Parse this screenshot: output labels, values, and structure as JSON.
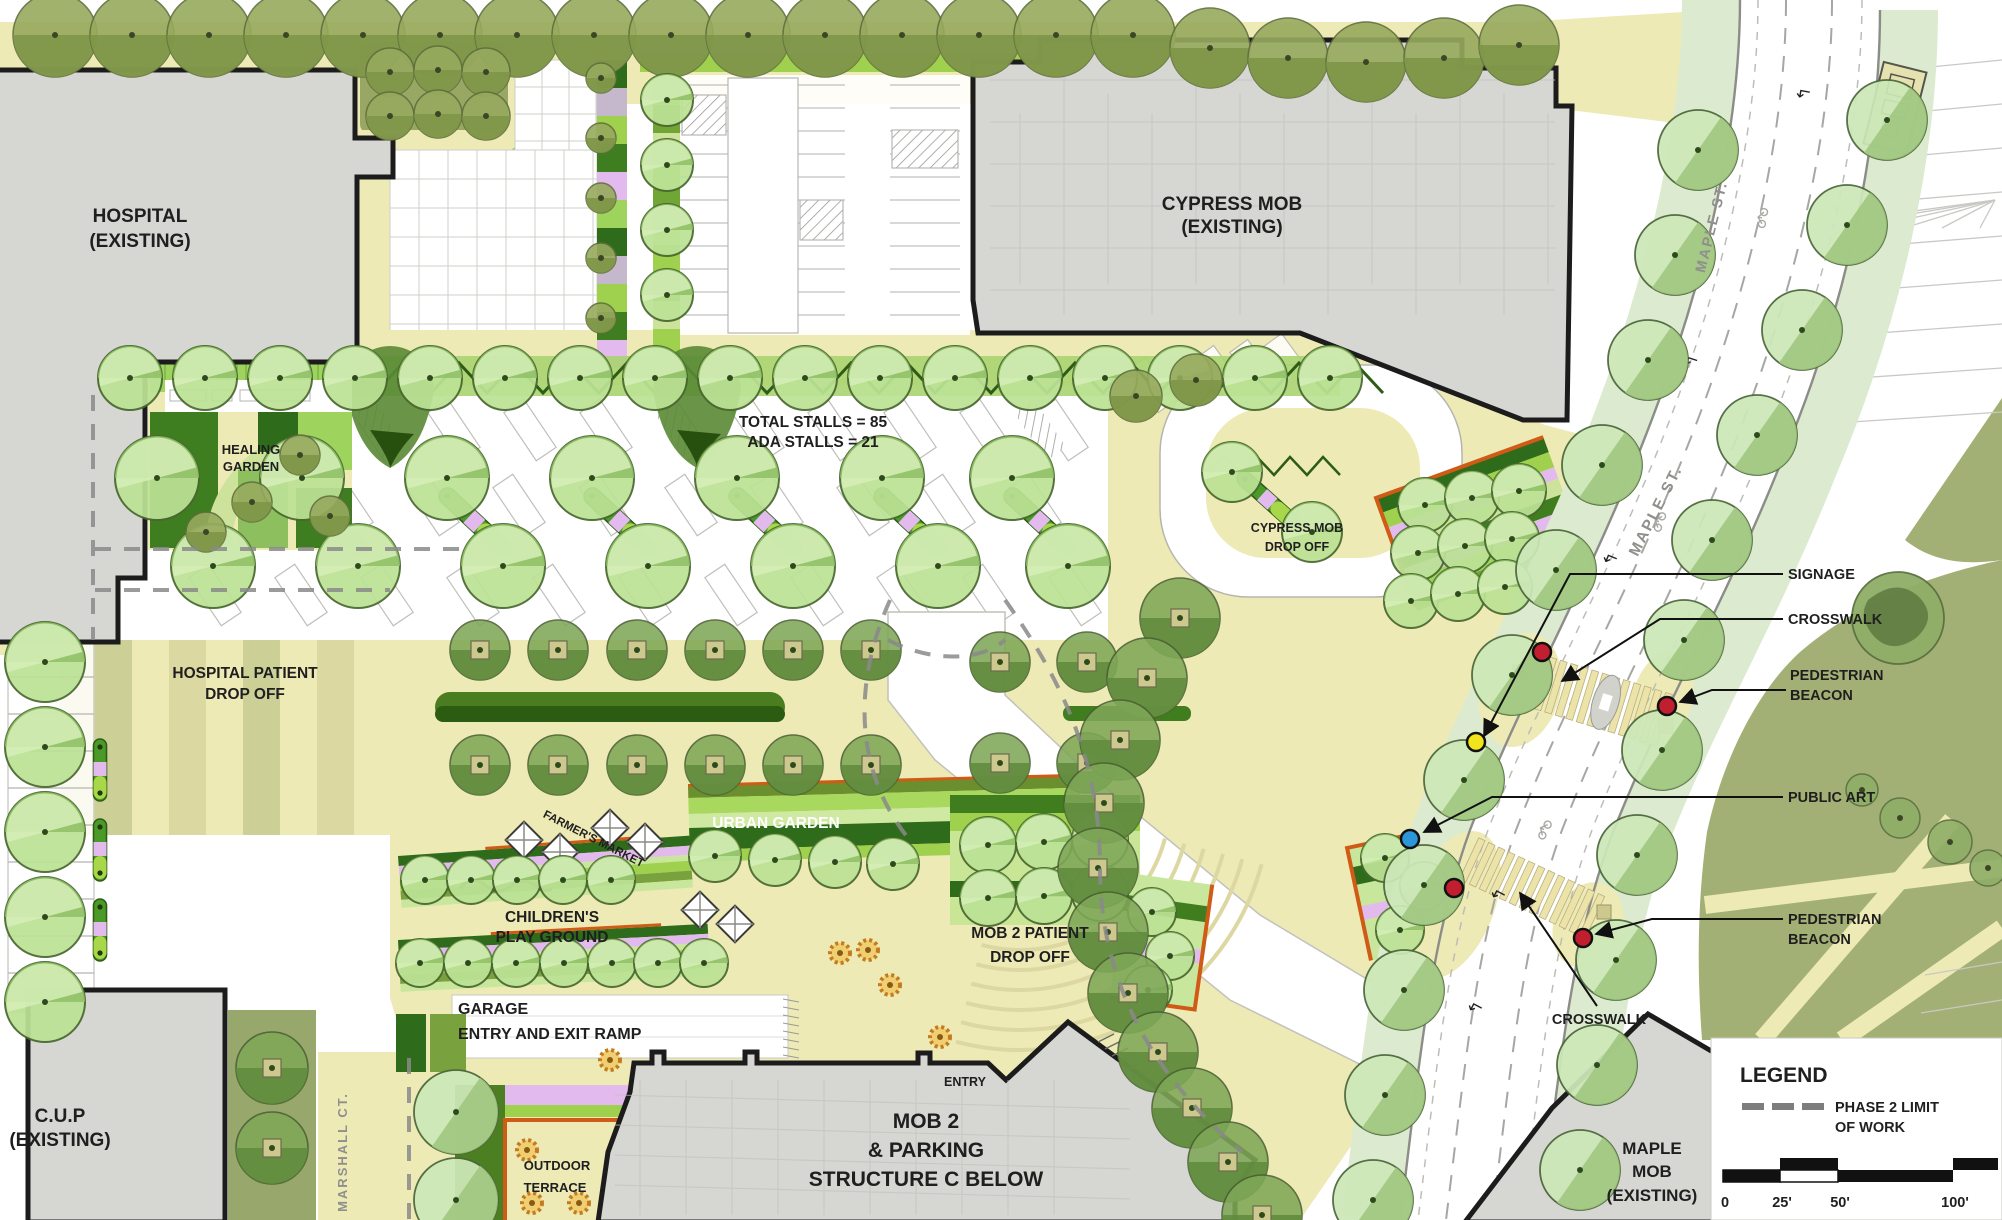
{
  "buildings": {
    "hospital": {
      "line1": "HOSPITAL",
      "line2": "(EXISTING)"
    },
    "cypress": {
      "line1": "CYPRESS MOB",
      "line2": "(EXISTING)"
    },
    "cup": {
      "line1": "C.U.P",
      "line2": "(EXISTING)"
    },
    "mob2": {
      "line1": "MOB 2",
      "line2": "& PARKING",
      "line3": "STRUCTURE C BELOW",
      "entry": "ENTRY"
    },
    "maple_mob": {
      "line1": "MAPLE",
      "line2": "MOB",
      "line3": "(EXISTING)"
    }
  },
  "areas": {
    "healing_garden": [
      "HEALING",
      "GARDEN"
    ],
    "hospital_drop": [
      "HOSPITAL PATIENT",
      "DROP OFF"
    ],
    "cypress_drop": [
      "CYPRESS MOB",
      "DROP OFF"
    ],
    "farmers_market": "FARMER'S MARKET",
    "urban_garden": "URBAN GARDEN",
    "childrens": [
      "CHILDREN'S",
      "PLAY GROUND"
    ],
    "mob2_drop": [
      "MOB 2 PATIENT",
      "DROP OFF"
    ],
    "garage": [
      "GARAGE",
      "ENTRY AND EXIT RAMP"
    ],
    "outdoor_terrace": [
      "OUTDOOR",
      "TERRACE"
    ]
  },
  "stats": {
    "total_stalls": "TOTAL STALLS = 85",
    "ada_stalls": "ADA STALLS = 21"
  },
  "streets": {
    "maple": "MAPLE ST.",
    "marshall": "MARSHALL CT."
  },
  "callouts": {
    "signage": "SIGNAGE",
    "crosswalk_upper": "CROSSWALK",
    "ped_beacon_upper": [
      "PEDESTRIAN",
      "BEACON"
    ],
    "public_art": "PUBLIC ART",
    "ped_beacon_lower": [
      "PEDESTRIAN",
      "BEACON"
    ],
    "crosswalk_lower": "CROSSWALK"
  },
  "legend": {
    "title": "LEGEND",
    "phase_line1": "PHASE 2 LIMIT",
    "phase_line2": "OF WORK",
    "scale_ticks": [
      "0",
      "25'",
      "50'",
      "100'"
    ]
  },
  "colors": {
    "building_fill": "#d6d6d3",
    "outline": "#1c1c1c",
    "paving_cream": "#eeeab6",
    "tree_light": "#bce295",
    "tree_olive": "#97aa5e",
    "accent_orange": "#cf5b16",
    "beacon_red": "#c11f2f",
    "signage_yellow": "#f2e41c",
    "public_art_blue": "#2b97d8",
    "pink_planting": "#e3baed",
    "lime_planting": "#9fd14e",
    "dark_green": "#2e6b1a",
    "park_olive": "#a3b075"
  }
}
